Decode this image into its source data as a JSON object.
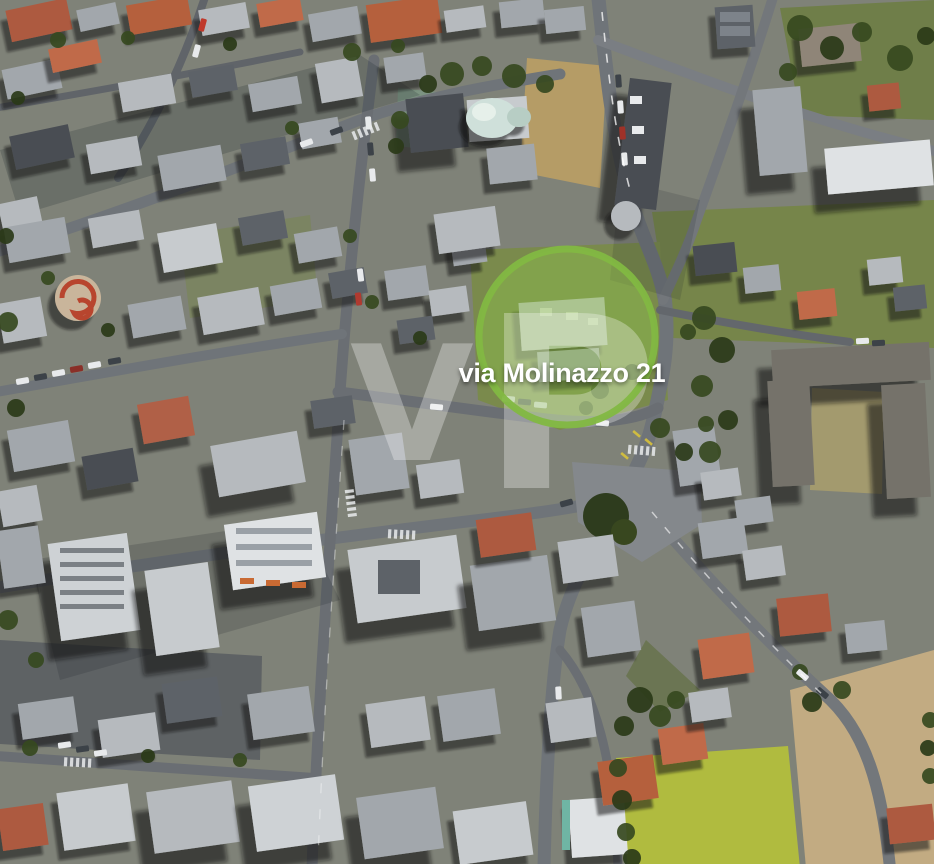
{
  "marker": {
    "label": "via Molinazzo 21",
    "label_color": "#ffffff",
    "ring_color": "#82b842",
    "fill_color": "#8dbd4e"
  },
  "watermark": {
    "text": "VP",
    "letters": [
      "V",
      "P"
    ],
    "color": "#ffffff"
  }
}
